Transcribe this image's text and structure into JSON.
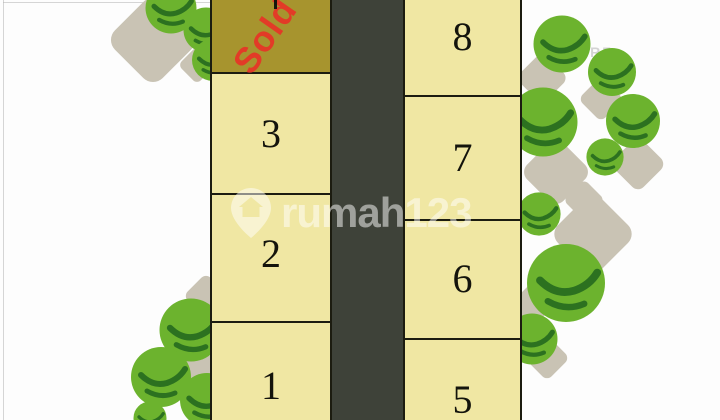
{
  "siteplan": {
    "lots_left": [
      {
        "label": "Sold",
        "status": "sold"
      },
      {
        "label": "3",
        "status": "available"
      },
      {
        "label": "2",
        "status": "available"
      },
      {
        "label": "1",
        "status": "available"
      }
    ],
    "lots_right": [
      {
        "label": "8",
        "status": "available"
      },
      {
        "label": "7",
        "status": "available"
      },
      {
        "label": "6",
        "status": "available"
      },
      {
        "label": "5",
        "status": "available"
      }
    ],
    "colors": {
      "lot_fill": "#f0e7a3",
      "sold_fill": "#a7942e",
      "sold_text": "#e23b27",
      "road": "#3e4239",
      "lot_border": "#1c1c10",
      "bush_green": "#6cb32e",
      "bush_dark_green": "#2c7120",
      "ground_blob": "#c9c3b4"
    }
  },
  "watermark": {
    "brand": "rumah123",
    "logo": "map-pin-house-icon"
  },
  "bg_watermark": {
    "text": "ARF"
  }
}
